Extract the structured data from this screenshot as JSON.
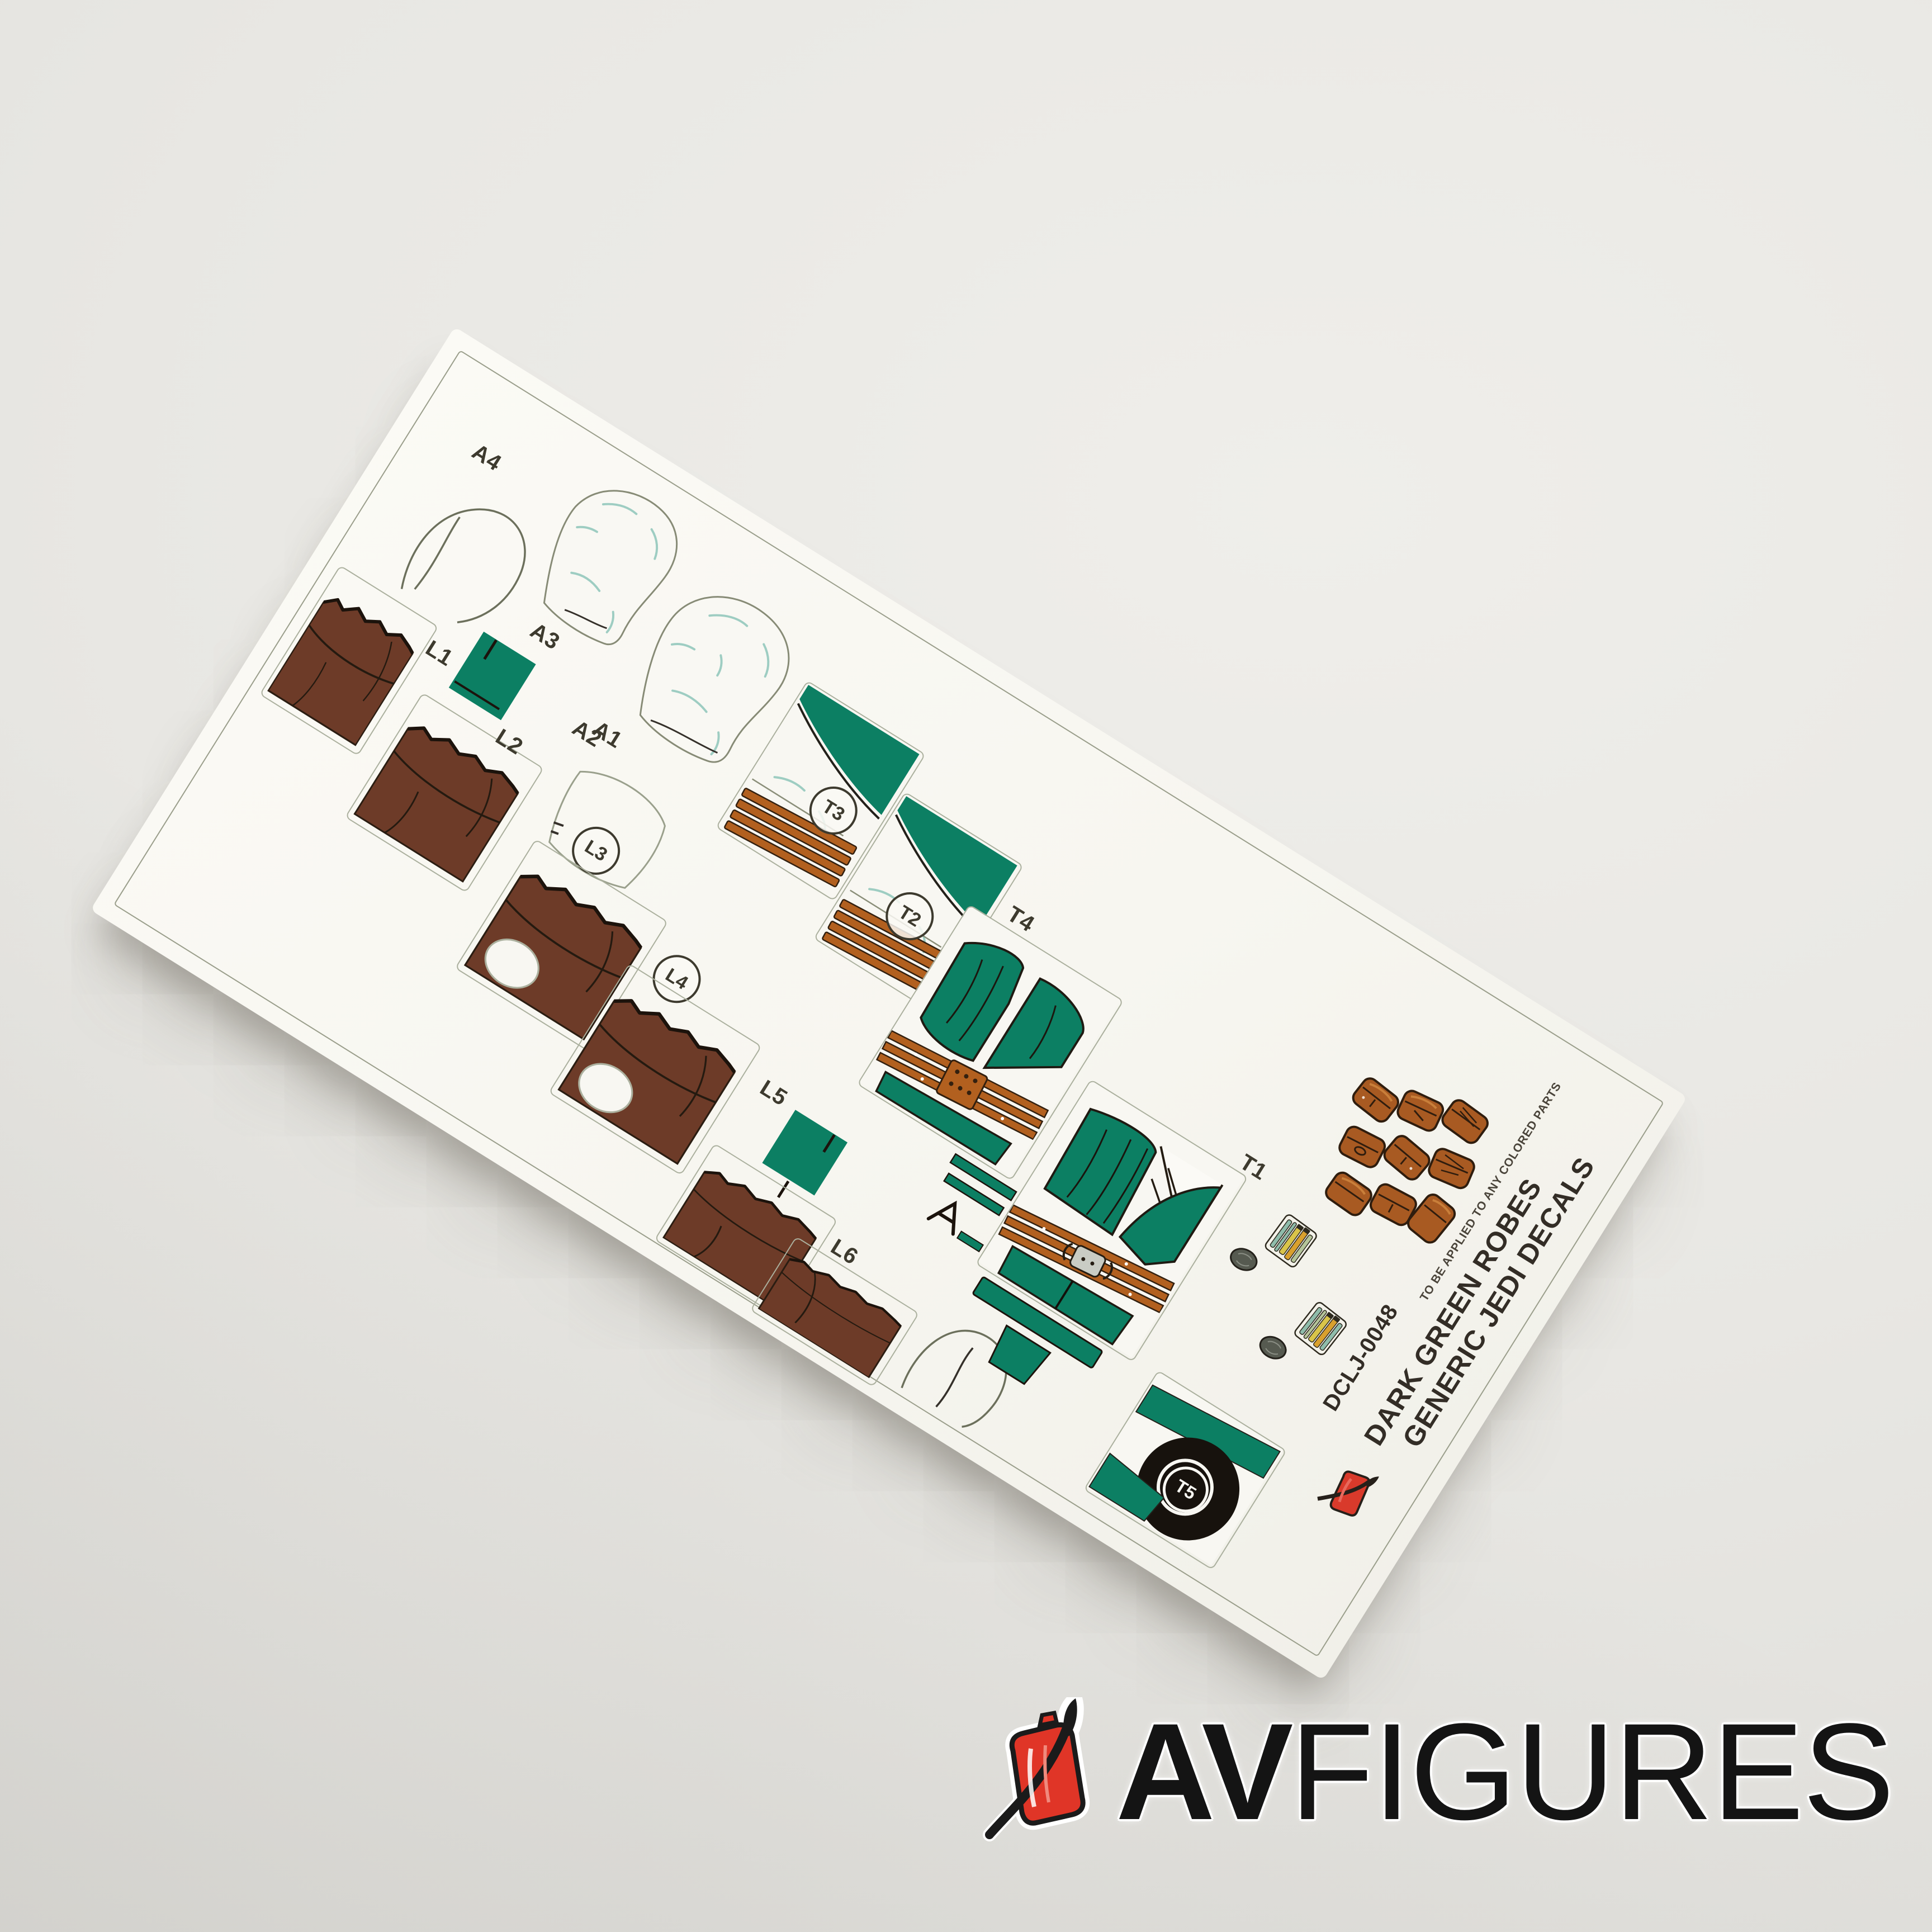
{
  "background_color": "#e8e7e3",
  "sheet": {
    "paper_color": "#f8f7f2",
    "frame_color": "#9a9e8b",
    "colors": {
      "robe_green": "#0c7f63",
      "belt_brown": "#b2601f",
      "leg_brown": "#6d3b28",
      "hood_crease_teal": "#9ecdc2",
      "pouch_brown": "#a85a22",
      "outline_dark": "#2b1d12"
    },
    "labels": {
      "a1": "A1",
      "a2": "A2",
      "a3": "A3",
      "a4": "A4",
      "l1": "L1",
      "l2": "L2",
      "l3": "L3",
      "l4": "L4",
      "l5": "L5",
      "l6": "L6",
      "t1": "T1",
      "t2": "T2",
      "t3": "T3",
      "t4": "T4",
      "t5": "T5"
    },
    "note": "TO BE APPLIED TO ANY COLORED PARTS",
    "title1": "GENERIC JEDI DECALS",
    "title2": "DARK GREEN ROBES",
    "code": "DCLJ-0048"
  },
  "watermark": {
    "brand_bold": "AV",
    "brand_regular": "FIGURES",
    "icon": "red-paintbrush-minifigure-logo"
  }
}
